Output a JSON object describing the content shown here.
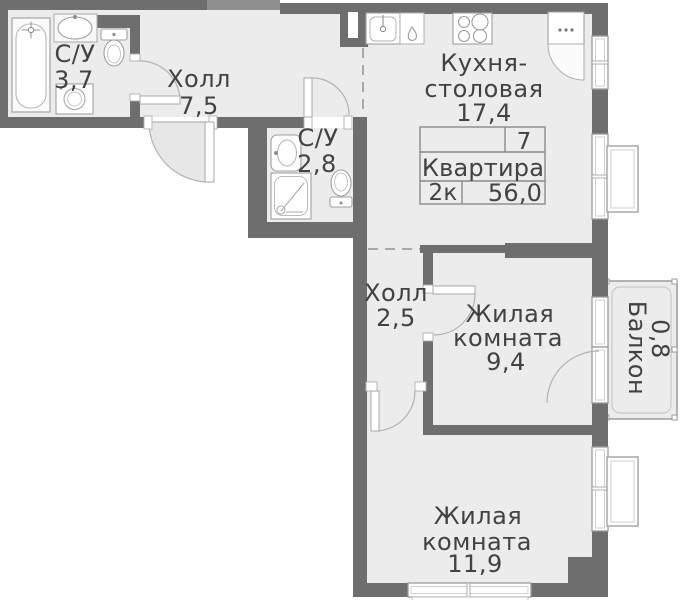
{
  "plan": {
    "rooms": [
      {
        "id": "bathroom-1",
        "label": "С/У",
        "area": "3,7"
      },
      {
        "id": "hall-1",
        "label": "Холл",
        "area": "7,5"
      },
      {
        "id": "bathroom-2",
        "label": "С/У",
        "area": "2,8"
      },
      {
        "id": "kitchen",
        "label_line1": "Кухня-",
        "label_line2": "столовая",
        "area": "17,4"
      },
      {
        "id": "hall-2",
        "label": "Холл",
        "area": "2,5"
      },
      {
        "id": "living-1",
        "label_line1": "Жилая",
        "label_line2": "комната",
        "area": "9,4"
      },
      {
        "id": "living-2",
        "label_line1": "Жилая",
        "label_line2": "комната",
        "area": "11,9"
      },
      {
        "id": "balcony",
        "label": "Балкон",
        "area": "0,8"
      }
    ],
    "info_box": {
      "number": "7",
      "type_label": "Квартира",
      "rooms_label": "2к",
      "total_area": "56,0"
    },
    "colors": {
      "wall": "#6e6e6e",
      "floor": "#ececec",
      "swing_fill": "#e7e7e7",
      "outline": "#a3a3a3",
      "text": "#424242"
    }
  }
}
